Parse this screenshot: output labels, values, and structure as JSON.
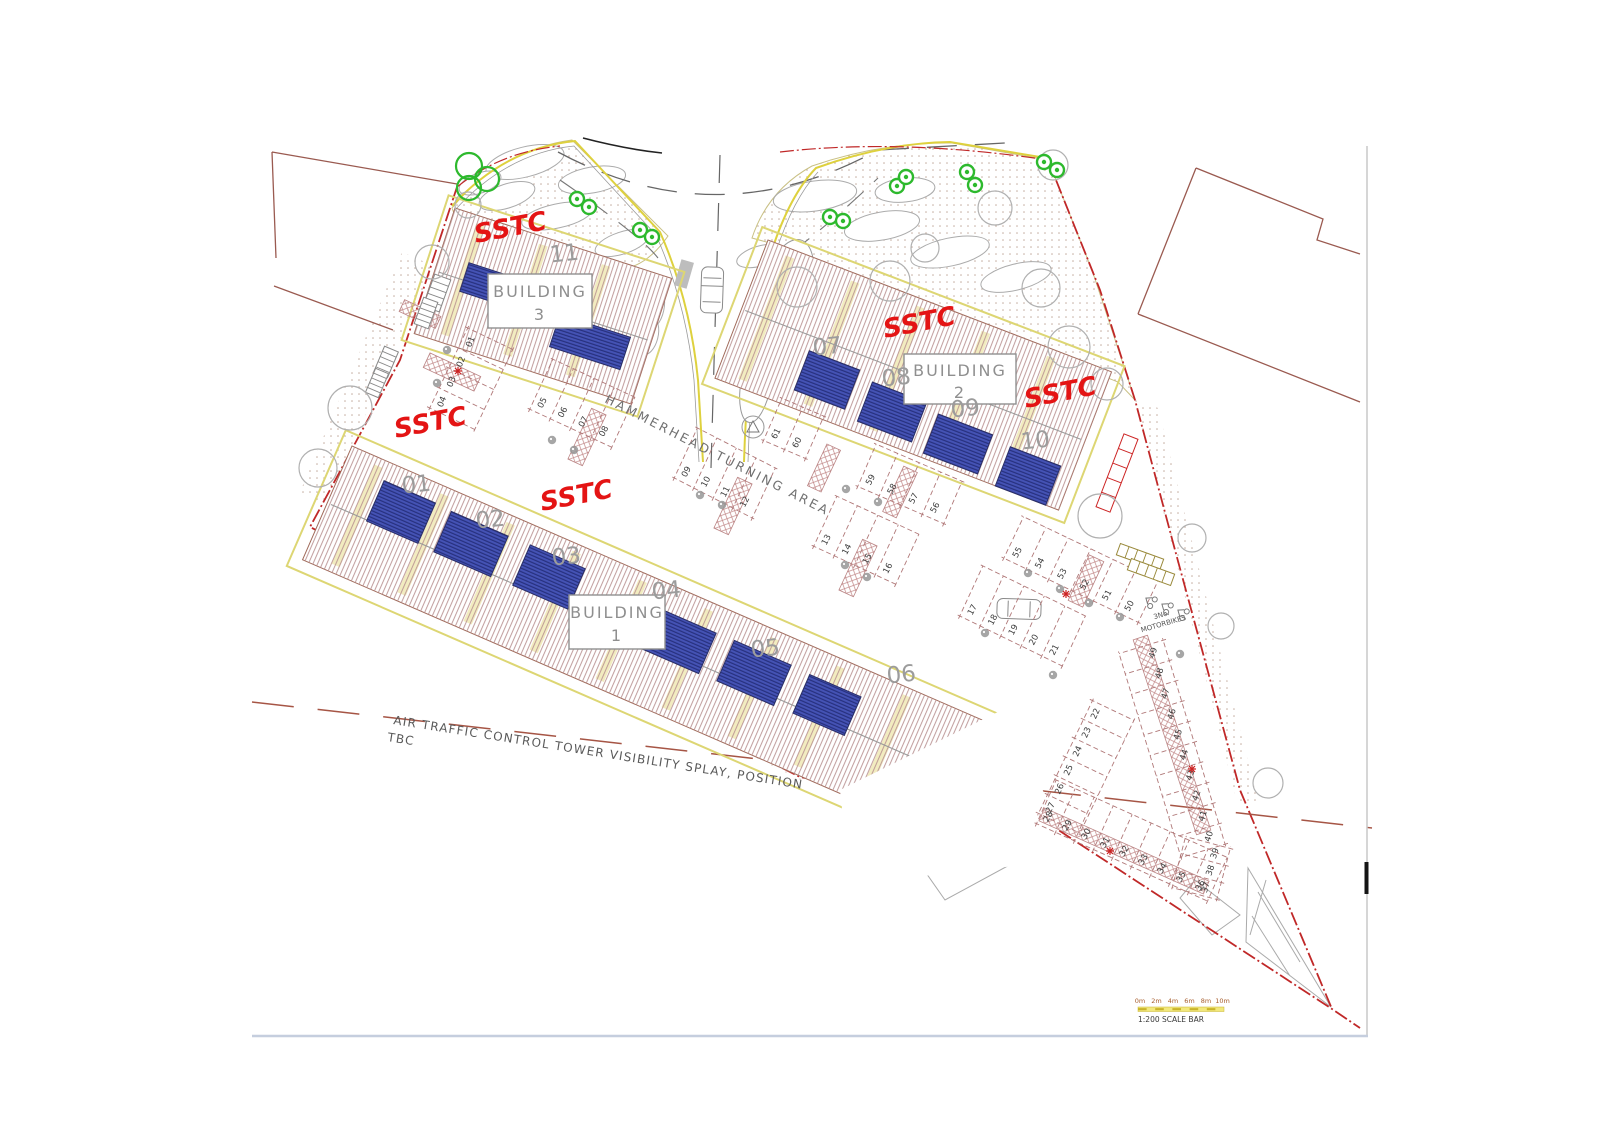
{
  "drawing": {
    "sstc_label": "SSTC",
    "buildings": [
      {
        "name": "BUILDING",
        "number": "1",
        "units": [
          "01",
          "02",
          "03",
          "04",
          "05",
          "06"
        ]
      },
      {
        "name": "BUILDING",
        "number": "2",
        "units": [
          "07",
          "08",
          "09",
          "10"
        ]
      },
      {
        "name": "BUILDING",
        "number": "3",
        "units": [
          "11"
        ]
      }
    ],
    "annotations": {
      "hammerhead": "HAMMERHEAD TURNING AREA",
      "atc_line1": "AIR TRAFFIC CONTROL TOWER VISIBILITY SPLAY, POSITION",
      "atc_line2": "TBC",
      "motorbikes_line1": "3No.",
      "motorbikes_line2": "MOTORBIKES"
    },
    "scale_bar": {
      "ticks": [
        "0m",
        "2m",
        "4m",
        "6m",
        "8m",
        "10m"
      ],
      "label": "1:200 SCALE BAR"
    },
    "parking": {
      "rows": [
        {
          "labels": [
            "01",
            "02",
            "03",
            "04"
          ]
        },
        {
          "labels": [
            "05",
            "06",
            "07",
            "08"
          ]
        },
        {
          "labels": [
            "09",
            "10",
            "11",
            "12"
          ]
        },
        {
          "labels": [
            "13",
            "14",
            "15",
            "16"
          ]
        },
        {
          "labels": [
            "17",
            "18",
            "19",
            "20",
            "21"
          ]
        },
        {
          "labels": [
            "22",
            "23",
            "24",
            "25",
            "26",
            "27"
          ]
        },
        {
          "labels": [
            "28",
            "29",
            "30",
            "31",
            "32",
            "33",
            "34",
            "35",
            "36"
          ]
        },
        {
          "labels": [
            "37",
            "38",
            "39"
          ]
        },
        {
          "labels": [
            "40",
            "41",
            "42",
            "43",
            "44",
            "45",
            "46",
            "47",
            "48",
            "49"
          ]
        },
        {
          "labels": [
            "50",
            "51",
            "52",
            "53",
            "54",
            "55"
          ]
        },
        {
          "labels": [
            "56",
            "57",
            "58",
            "59"
          ]
        },
        {
          "labels": [
            "60",
            "61"
          ]
        }
      ]
    },
    "colors": {
      "hatch": "#b89090",
      "panel_blue": "#4553b5",
      "panel_stripe": "#27307e",
      "sstc_red": "#e41414",
      "boundary_red": "#c02828",
      "curb_yellow": "#ded13e",
      "tree_green": "#2db92d",
      "adjacent_brown": "#9a5a50"
    }
  }
}
